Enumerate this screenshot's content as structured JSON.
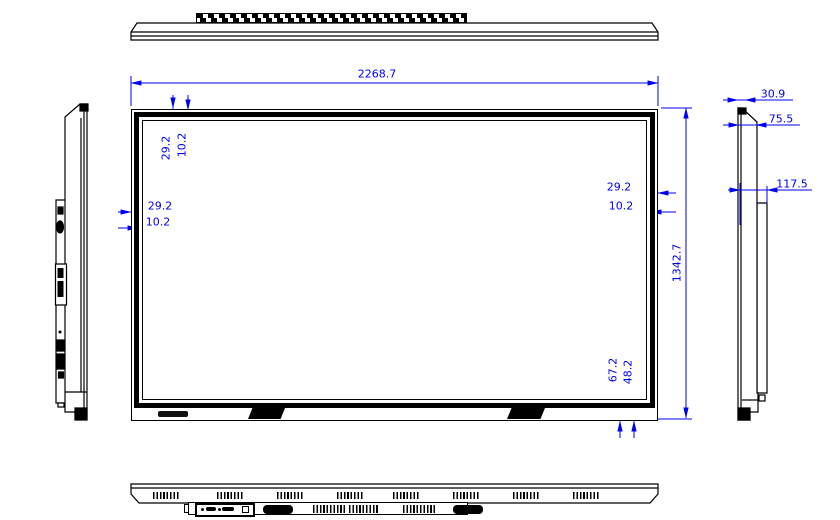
{
  "drawing": {
    "type": "technical-dimension-drawing",
    "subject": "flat-panel-display",
    "colors": {
      "dimension": "#0000f0",
      "linework": "#000000",
      "background": "#ffffff"
    }
  },
  "dims": {
    "overall_width": "2268.7",
    "overall_height": "1342.7",
    "top_bezel": "29.2",
    "top_border": "10.2",
    "left_bezel": "29.2",
    "left_border": "10.2",
    "right_bezel": "29.2",
    "right_border": "10.2",
    "bottom_bezel": "67.2",
    "bottom_border": "48.2",
    "front_thickness": "30.9",
    "body_depth": "75.5",
    "total_depth": "117.5"
  }
}
